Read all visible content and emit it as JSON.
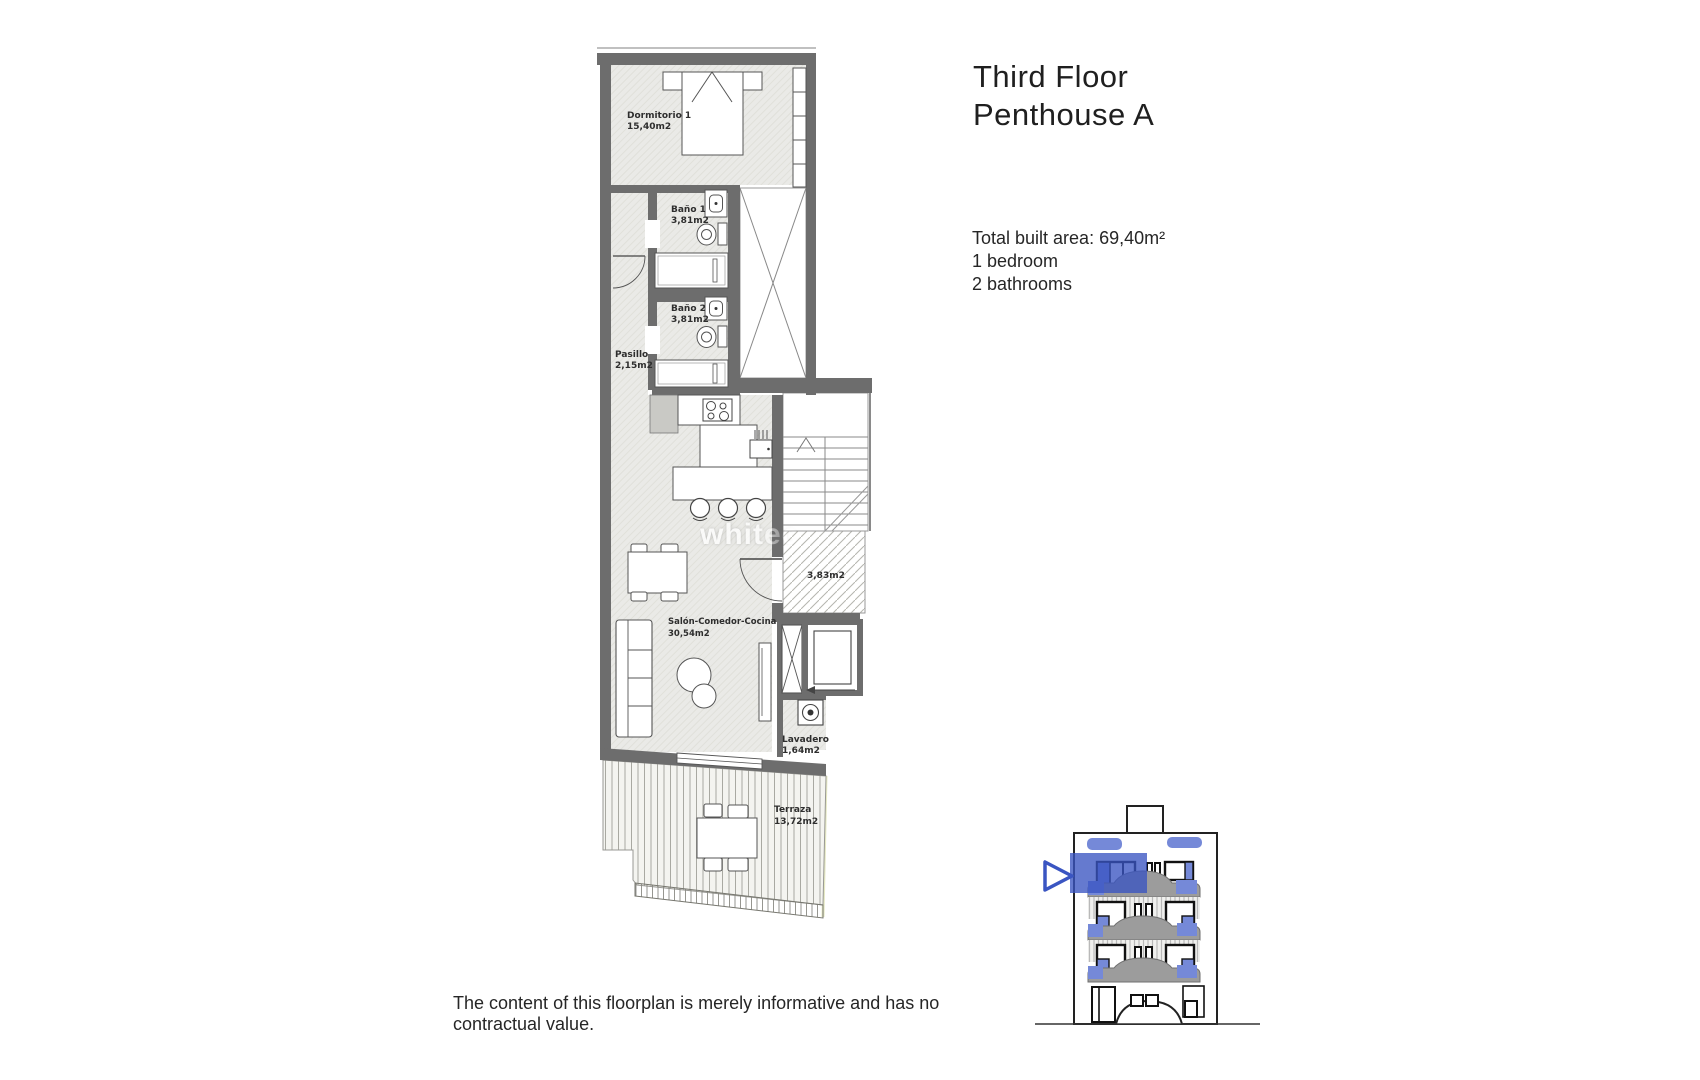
{
  "header": {
    "title_line1": "Third Floor",
    "title_line2": "Penthouse A"
  },
  "details": {
    "built_area": "Total built area: 69,40m²",
    "bedrooms": "1 bedroom",
    "bathrooms": "2 bathrooms"
  },
  "disclaimer": "The content of this floorplan is merely informative and has no contractual value.",
  "watermark": "whitec",
  "floorplan": {
    "rooms": {
      "dormitorio": {
        "name": "Dormitorio 1",
        "area": "15,40m2"
      },
      "bano1": {
        "name": "Baño 1",
        "area": "3,81m2"
      },
      "bano2": {
        "name": "Baño 2",
        "area": "3,81m2"
      },
      "pasillo": {
        "name": "Pasillo",
        "area": "2,15m2"
      },
      "salon": {
        "name": "Salón-Comedor-Cocina",
        "area": "30,54m2"
      },
      "lavadero": {
        "name": "Lavadero",
        "area": "1,64m2"
      },
      "terraza": {
        "name": "Terraza",
        "area": "13,72m2"
      },
      "hueco": {
        "area": "3,83m2"
      }
    }
  },
  "colors": {
    "wall_gray": "#6d6d6d",
    "floor_gray": "#eaeae7",
    "accent_blue": "#3a55c2",
    "window_blue": "#7589d8"
  }
}
